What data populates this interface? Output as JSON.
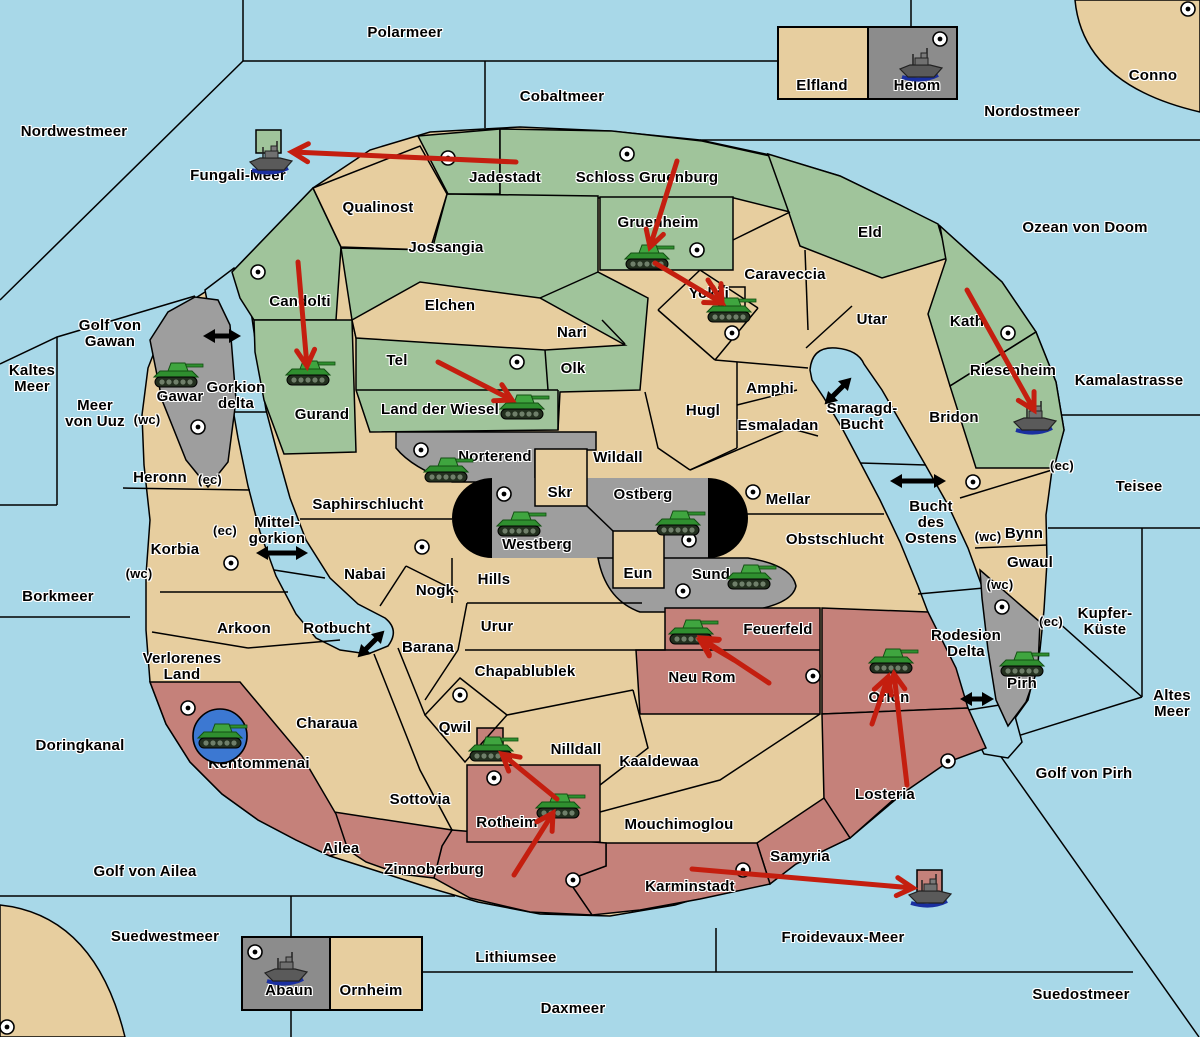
{
  "map": {
    "colors": {
      "sea": "#A8D8E8",
      "land": "#E7CE9F",
      "green": "#A0C49B",
      "gray": "#9E9E9E",
      "darkgray": "#8C8C8C",
      "red": "#C5817A",
      "arrow_red": "#C41E0F",
      "strait_black": "#000000",
      "tank_green": "#3FA03F",
      "ship_gray": "#5A5A5A",
      "convoy_disc_blue": "#3C78D2"
    },
    "sea_regions": [
      {
        "name": "Polarmeer",
        "x": 405,
        "y": 33
      },
      {
        "name": "Cobaltmeer",
        "x": 562,
        "y": 97
      },
      {
        "name": "Nordwestmeer",
        "x": 74,
        "y": 132
      },
      {
        "name": "Fungali-Meer",
        "x": 238,
        "y": 176
      },
      {
        "name": "Nordostmeer",
        "x": 1032,
        "y": 112
      },
      {
        "name": "Ozean von Doom",
        "x": 1085,
        "y": 228
      },
      {
        "name": "Kamalastrasse",
        "x": 1129,
        "y": 381
      },
      {
        "name": "Teisee",
        "x": 1139,
        "y": 487
      },
      {
        "name": "Kupfer-\nKüste",
        "x": 1105,
        "y": 622
      },
      {
        "name": "Altes\nMeer",
        "x": 1172,
        "y": 704
      },
      {
        "name": "Golf von Pirh",
        "x": 1084,
        "y": 774
      },
      {
        "name": "Suedostmeer",
        "x": 1081,
        "y": 995
      },
      {
        "name": "Froidevaux-Meer",
        "x": 843,
        "y": 938
      },
      {
        "name": "Daxmeer",
        "x": 573,
        "y": 1009
      },
      {
        "name": "Lithiumsee",
        "x": 516,
        "y": 958
      },
      {
        "name": "Suedwestmeer",
        "x": 165,
        "y": 937
      },
      {
        "name": "Golf von Ailea",
        "x": 145,
        "y": 872
      },
      {
        "name": "Doringkanal",
        "x": 80,
        "y": 746
      },
      {
        "name": "Borkmeer",
        "x": 58,
        "y": 597
      },
      {
        "name": "Kaltes\nMeer",
        "x": 32,
        "y": 379
      },
      {
        "name": "Golf von\nGawan",
        "x": 110,
        "y": 334
      },
      {
        "name": "Meer\nvon Uuz",
        "x": 95,
        "y": 414
      },
      {
        "name": "Gorkion\ndelta",
        "x": 236,
        "y": 396
      },
      {
        "name": "Mittel-\ngorkion",
        "x": 277,
        "y": 531
      },
      {
        "name": "Rotbucht",
        "x": 337,
        "y": 629
      },
      {
        "name": "Smaragd-\nBucht",
        "x": 862,
        "y": 417
      },
      {
        "name": "Bucht\ndes\nOstens",
        "x": 931,
        "y": 523
      },
      {
        "name": "Rodesion\nDelta",
        "x": 966,
        "y": 644
      }
    ],
    "land_regions": [
      {
        "name": "Conno",
        "x": 1153,
        "y": 76
      },
      {
        "name": "Elfland",
        "x": 822,
        "y": 86
      },
      {
        "name": "Helom",
        "x": 917,
        "y": 86
      },
      {
        "name": "Jadestadt",
        "x": 505,
        "y": 178
      },
      {
        "name": "Schloss Gruenburg",
        "x": 647,
        "y": 178
      },
      {
        "name": "Qualinost",
        "x": 378,
        "y": 208
      },
      {
        "name": "Jossangia",
        "x": 446,
        "y": 248
      },
      {
        "name": "Gruenheim",
        "x": 658,
        "y": 223
      },
      {
        "name": "Candolti",
        "x": 300,
        "y": 302
      },
      {
        "name": "Gurand",
        "x": 322,
        "y": 415
      },
      {
        "name": "Elchen",
        "x": 450,
        "y": 306
      },
      {
        "name": "Nari",
        "x": 572,
        "y": 333
      },
      {
        "name": "Olk",
        "x": 573,
        "y": 369
      },
      {
        "name": "Tel",
        "x": 397,
        "y": 361
      },
      {
        "name": "Land der Wiesel",
        "x": 440,
        "y": 410
      },
      {
        "name": "Yokai",
        "x": 709,
        "y": 294
      },
      {
        "name": "Caraveccia",
        "x": 785,
        "y": 275
      },
      {
        "name": "Eld",
        "x": 870,
        "y": 233
      },
      {
        "name": "Utar",
        "x": 872,
        "y": 320
      },
      {
        "name": "Kath",
        "x": 967,
        "y": 322
      },
      {
        "name": "Riesenheim",
        "x": 1013,
        "y": 371
      },
      {
        "name": "Bridon",
        "x": 954,
        "y": 418
      },
      {
        "name": "Amphi",
        "x": 770,
        "y": 389
      },
      {
        "name": "Esmaladan",
        "x": 778,
        "y": 426
      },
      {
        "name": "Hugl",
        "x": 703,
        "y": 411
      },
      {
        "name": "Wildall",
        "x": 618,
        "y": 458
      },
      {
        "name": "Norterend",
        "x": 495,
        "y": 457
      },
      {
        "name": "Skr",
        "x": 560,
        "y": 493
      },
      {
        "name": "Ostberg",
        "x": 643,
        "y": 495
      },
      {
        "name": "Westberg",
        "x": 537,
        "y": 545
      },
      {
        "name": "Eun",
        "x": 638,
        "y": 574
      },
      {
        "name": "Sund",
        "x": 711,
        "y": 575
      },
      {
        "name": "Mellar",
        "x": 788,
        "y": 500
      },
      {
        "name": "Obstschlucht",
        "x": 835,
        "y": 540
      },
      {
        "name": "Gawar",
        "x": 180,
        "y": 397
      },
      {
        "name": "Heronn",
        "x": 160,
        "y": 478
      },
      {
        "name": "Korbia",
        "x": 175,
        "y": 550
      },
      {
        "name": "Saphirschlucht",
        "x": 368,
        "y": 505
      },
      {
        "name": "Nabai",
        "x": 365,
        "y": 575
      },
      {
        "name": "Nogk",
        "x": 435,
        "y": 591
      },
      {
        "name": "Hills",
        "x": 494,
        "y": 580
      },
      {
        "name": "Urur",
        "x": 497,
        "y": 627
      },
      {
        "name": "Barana",
        "x": 428,
        "y": 648
      },
      {
        "name": "Arkoon",
        "x": 244,
        "y": 629
      },
      {
        "name": "Chapablublek",
        "x": 525,
        "y": 672
      },
      {
        "name": "Qwil",
        "x": 455,
        "y": 728
      },
      {
        "name": "Nilldall",
        "x": 576,
        "y": 750
      },
      {
        "name": "Kaaldewaa",
        "x": 659,
        "y": 762
      },
      {
        "name": "Neu Rom",
        "x": 702,
        "y": 678
      },
      {
        "name": "Feuerfeld",
        "x": 778,
        "y": 630
      },
      {
        "name": "Orlon",
        "x": 889,
        "y": 698
      },
      {
        "name": "Losteria",
        "x": 885,
        "y": 795
      },
      {
        "name": "Bynn",
        "x": 1024,
        "y": 534
      },
      {
        "name": "Gwaul",
        "x": 1030,
        "y": 563
      },
      {
        "name": "Pirh",
        "x": 1022,
        "y": 684
      },
      {
        "name": "Verlorenes\nLand",
        "x": 182,
        "y": 667
      },
      {
        "name": "Kentommenai",
        "x": 259,
        "y": 764
      },
      {
        "name": "Charaua",
        "x": 327,
        "y": 724
      },
      {
        "name": "Sottovia",
        "x": 420,
        "y": 800
      },
      {
        "name": "Ailea",
        "x": 341,
        "y": 849
      },
      {
        "name": "Zinnoberburg",
        "x": 434,
        "y": 870
      },
      {
        "name": "Rotheim",
        "x": 507,
        "y": 823
      },
      {
        "name": "Mouchimoglou",
        "x": 679,
        "y": 825
      },
      {
        "name": "Karminstadt",
        "x": 690,
        "y": 887
      },
      {
        "name": "Samyria",
        "x": 800,
        "y": 857
      },
      {
        "name": "Abaun",
        "x": 289,
        "y": 991
      },
      {
        "name": "Ornheim",
        "x": 371,
        "y": 991
      }
    ],
    "coast_markers": [
      {
        "text": "(wc)",
        "x": 147,
        "y": 420
      },
      {
        "text": "(ec)",
        "x": 210,
        "y": 480
      },
      {
        "text": "(ec)",
        "x": 225,
        "y": 531
      },
      {
        "text": "(wc)",
        "x": 139,
        "y": 574
      },
      {
        "text": "(ec)",
        "x": 1062,
        "y": 466
      },
      {
        "text": "(wc)",
        "x": 988,
        "y": 537
      },
      {
        "text": "(wc)",
        "x": 1000,
        "y": 585
      },
      {
        "text": "(ec)",
        "x": 1051,
        "y": 622
      }
    ],
    "supply_centers": [
      {
        "x": 448,
        "y": 158
      },
      {
        "x": 627,
        "y": 154
      },
      {
        "x": 697,
        "y": 250
      },
      {
        "x": 732,
        "y": 333
      },
      {
        "x": 258,
        "y": 272
      },
      {
        "x": 517,
        "y": 362
      },
      {
        "x": 198,
        "y": 427
      },
      {
        "x": 1008,
        "y": 333
      },
      {
        "x": 1188,
        "y": 9
      },
      {
        "x": 940,
        "y": 39
      },
      {
        "x": 421,
        "y": 450
      },
      {
        "x": 504,
        "y": 494
      },
      {
        "x": 689,
        "y": 540
      },
      {
        "x": 683,
        "y": 591
      },
      {
        "x": 753,
        "y": 492
      },
      {
        "x": 422,
        "y": 547
      },
      {
        "x": 813,
        "y": 676
      },
      {
        "x": 948,
        "y": 761
      },
      {
        "x": 973,
        "y": 482
      },
      {
        "x": 231,
        "y": 563
      },
      {
        "x": 188,
        "y": 708
      },
      {
        "x": 460,
        "y": 695
      },
      {
        "x": 494,
        "y": 778
      },
      {
        "x": 573,
        "y": 880
      },
      {
        "x": 743,
        "y": 870
      },
      {
        "x": 7,
        "y": 1027
      },
      {
        "x": 255,
        "y": 952
      },
      {
        "x": 1002,
        "y": 607
      }
    ],
    "units": [
      {
        "type": "tank",
        "x": 176,
        "y": 375
      },
      {
        "type": "tank",
        "x": 308,
        "y": 373
      },
      {
        "type": "tank",
        "x": 522,
        "y": 407
      },
      {
        "type": "tank",
        "x": 647,
        "y": 257
      },
      {
        "type": "tank",
        "x": 729,
        "y": 310
      },
      {
        "type": "tank",
        "x": 446,
        "y": 470
      },
      {
        "type": "tank",
        "x": 519,
        "y": 524
      },
      {
        "type": "tank",
        "x": 678,
        "y": 523
      },
      {
        "type": "tank",
        "x": 749,
        "y": 577
      },
      {
        "type": "tank",
        "x": 691,
        "y": 632
      },
      {
        "type": "tank",
        "x": 891,
        "y": 661
      },
      {
        "type": "tank",
        "x": 491,
        "y": 749
      },
      {
        "type": "tank",
        "x": 558,
        "y": 806
      },
      {
        "type": "tank",
        "x": 1022,
        "y": 664
      },
      {
        "type": "tank-disc",
        "x": 220,
        "y": 736
      },
      {
        "type": "ship",
        "x": 272,
        "y": 156
      },
      {
        "type": "ship",
        "x": 922,
        "y": 63
      },
      {
        "type": "ship",
        "x": 1036,
        "y": 416
      },
      {
        "type": "ship",
        "x": 931,
        "y": 889
      },
      {
        "type": "ship",
        "x": 287,
        "y": 967
      }
    ],
    "move_arrows": [
      {
        "x1": 516,
        "y1": 162,
        "x2": 292,
        "y2": 152
      },
      {
        "x1": 677,
        "y1": 161,
        "x2": 650,
        "y2": 247
      },
      {
        "x1": 655,
        "y1": 263,
        "x2": 722,
        "y2": 303
      },
      {
        "x1": 708,
        "y1": 280,
        "x2": 722,
        "y2": 302
      },
      {
        "x1": 298,
        "y1": 262,
        "x2": 307,
        "y2": 366
      },
      {
        "x1": 438,
        "y1": 362,
        "x2": 512,
        "y2": 400
      },
      {
        "x1": 967,
        "y1": 290,
        "x2": 1034,
        "y2": 410
      },
      {
        "x1": 769,
        "y1": 683,
        "x2": 701,
        "y2": 638
      },
      {
        "x1": 734,
        "y1": 660,
        "x2": 700,
        "y2": 640
      },
      {
        "x1": 907,
        "y1": 785,
        "x2": 894,
        "y2": 674
      },
      {
        "x1": 872,
        "y1": 724,
        "x2": 888,
        "y2": 677
      },
      {
        "x1": 557,
        "y1": 799,
        "x2": 502,
        "y2": 754
      },
      {
        "x1": 514,
        "y1": 875,
        "x2": 553,
        "y2": 813
      },
      {
        "x1": 692,
        "y1": 869,
        "x2": 913,
        "y2": 888
      }
    ],
    "strait_arrows": [
      {
        "x": 222,
        "y": 336,
        "angle": 0,
        "len": 38
      },
      {
        "x": 282,
        "y": 553,
        "angle": 0,
        "len": 52
      },
      {
        "x": 371,
        "y": 644,
        "angle": -45,
        "len": 38
      },
      {
        "x": 838,
        "y": 391,
        "angle": -45,
        "len": 38
      },
      {
        "x": 918,
        "y": 481,
        "angle": 0,
        "len": 56
      },
      {
        "x": 977,
        "y": 699,
        "angle": 0,
        "len": 34
      }
    ]
  }
}
